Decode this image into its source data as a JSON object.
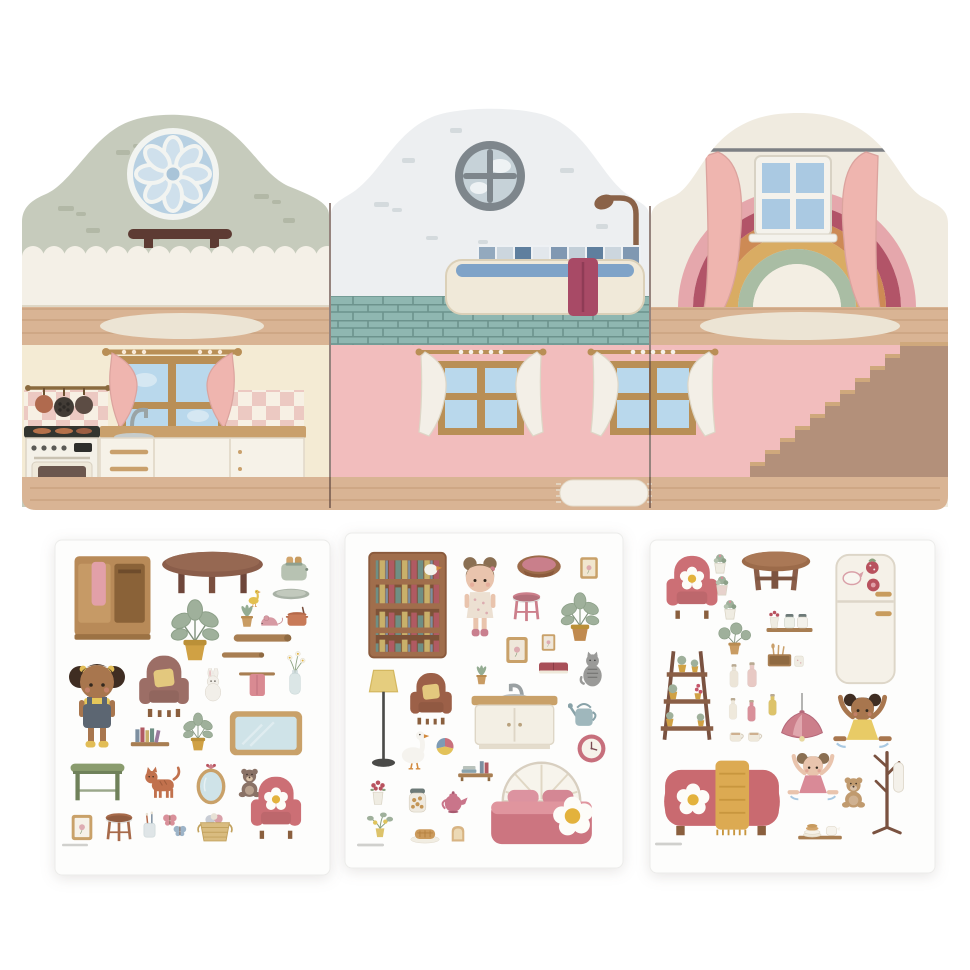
{
  "scene": "fold-out dollhouse backdrop with three sticker sheets of dollhouse furniture and dolls",
  "colors": {
    "page_bg": "#ffffff",
    "sheet_bg": "#fdfdfc",
    "wall_sage": "#c6cbbc",
    "wall_white": "#edeff1",
    "wall_cream": "#f0ebe0",
    "kitchen_wall": "#f4ebd4",
    "wall_pink": "#f2bdbd",
    "wood": "#d9b494",
    "wood_line": "#c49c78",
    "wood_top": "#c9a06c",
    "fence": "#f4f0e7",
    "curtain_pink": "#efb5af",
    "pane_blue": "#b9d8ec",
    "frame_wood": "#b98f56",
    "tile_teal": "#8fb7b1",
    "tile_grout": "#6c938d",
    "shelf_dark": "#5d3b33",
    "towel_magenta": "#a84a66",
    "stair": "#b3907a",
    "stair_tread": "#cfa87c",
    "rug_cream": "#ece4d4",
    "separator": "#6a5048",
    "rainbow_1": "#e5a7ac",
    "rainbow_2": "#b25468",
    "rainbow_3": "#cd8a55",
    "rainbow_4": "#d9ac63",
    "rainbow_5": "#a9bda4",
    "rainbow_center": "#f3eee3"
  },
  "backdrop": {
    "panels": [
      {
        "name": "left-panel",
        "upper_room": "living-room-attic",
        "upper_elements": [
          "rosette-window",
          "wall-shelf",
          "picket-fence",
          "oval-rug"
        ],
        "lower_room": "kitchen",
        "lower_elements": [
          "window-with-pink-curtains",
          "utensil-rail-with-pans",
          "checkered-backsplash",
          "stove-oven",
          "sink-counter-drawers"
        ]
      },
      {
        "name": "middle-panel",
        "upper_room": "bathroom",
        "upper_elements": [
          "porthole-window",
          "shower",
          "tile-strip",
          "bathtub",
          "magenta-towel",
          "teal-tiled-floor"
        ],
        "lower_room": "pink-room",
        "lower_elements": [
          "window-white-curtains-left",
          "window-white-curtains-right",
          "fringed-rug"
        ]
      },
      {
        "name": "right-panel",
        "upper_room": "attic-bedroom",
        "upper_elements": [
          "curtain-rod",
          "pink-curtains",
          "white-window",
          "rainbow",
          "oval-rug"
        ],
        "lower_room": "stair-hall",
        "lower_elements": [
          "staircase"
        ]
      }
    ]
  },
  "sheets": [
    {
      "id": "sheet-1",
      "items": [
        {
          "name": "wardrobe-with-towel",
          "icon": "wardrobe",
          "x": 10,
          "y": 8,
          "w": 95,
          "h": 100
        },
        {
          "name": "oval-coffee-table",
          "icon": "table-oval",
          "x": 100,
          "y": 10,
          "w": 115,
          "h": 45
        },
        {
          "name": "toaster",
          "icon": "toaster",
          "x": 222,
          "y": 10,
          "w": 34,
          "h": 38
        },
        {
          "name": "duckling",
          "icon": "bird",
          "x": 188,
          "y": 48,
          "w": 22,
          "h": 20,
          "c": {
            "a": "#e3c050"
          }
        },
        {
          "name": "serving-tray",
          "icon": "tray",
          "x": 212,
          "y": 46,
          "w": 48,
          "h": 16
        },
        {
          "name": "succulent",
          "icon": "plant-small",
          "x": 182,
          "y": 62,
          "w": 20,
          "h": 28
        },
        {
          "name": "toy-mouse",
          "icon": "mouse",
          "x": 200,
          "y": 72,
          "w": 30,
          "h": 18
        },
        {
          "name": "cooking-pot",
          "icon": "pot",
          "x": 228,
          "y": 64,
          "w": 28,
          "h": 26
        },
        {
          "name": "potted-plant",
          "icon": "plant",
          "x": 105,
          "y": 55,
          "w": 70,
          "h": 68
        },
        {
          "name": "shelf-board-long",
          "icon": "plank",
          "x": 165,
          "y": 92,
          "w": 85,
          "h": 12
        },
        {
          "name": "shelf-board-short",
          "icon": "plank",
          "x": 166,
          "y": 110,
          "w": 44,
          "h": 10
        },
        {
          "name": "doll-girl-overalls",
          "icon": "doll-pigtails",
          "x": 10,
          "y": 110,
          "w": 64,
          "h": 100,
          "c": {
            "s": "#a8764e",
            "h": "#3f2d22",
            "d": "#5c6672"
          }
        },
        {
          "name": "mauve-armchair",
          "icon": "armchair",
          "x": 78,
          "y": 110,
          "w": 62,
          "h": 72,
          "c": {
            "a": "#9c6e66",
            "b": "#e3c87e"
          }
        },
        {
          "name": "bunny",
          "icon": "bunny",
          "x": 143,
          "y": 128,
          "w": 30,
          "h": 34
        },
        {
          "name": "towel-rail",
          "icon": "towel-rail",
          "x": 180,
          "y": 126,
          "w": 44,
          "h": 34
        },
        {
          "name": "flower-vase",
          "icon": "vase-flowers",
          "x": 228,
          "y": 108,
          "w": 24,
          "h": 52
        },
        {
          "name": "wall-shelf-books",
          "icon": "wallshelf",
          "x": 70,
          "y": 182,
          "w": 50,
          "h": 32
        },
        {
          "name": "potted-plant-2",
          "icon": "plant",
          "x": 122,
          "y": 168,
          "w": 42,
          "h": 46,
          "c": {
            "a": "#d0a144"
          }
        },
        {
          "name": "blue-board",
          "icon": "board",
          "x": 170,
          "y": 165,
          "w": 82,
          "h": 55
        },
        {
          "name": "green-desk",
          "icon": "desk",
          "x": 10,
          "y": 215,
          "w": 65,
          "h": 49,
          "c": {
            "a": "#8a9c6e"
          }
        },
        {
          "name": "ginger-cat",
          "icon": "cat",
          "x": 83,
          "y": 220,
          "w": 47,
          "h": 44,
          "c": {
            "a": "#c1714d"
          }
        },
        {
          "name": "oval-mirror",
          "icon": "mirror",
          "x": 135,
          "y": 221,
          "w": 42,
          "h": 44
        },
        {
          "name": "teddy-bear",
          "icon": "teddy",
          "x": 180,
          "y": 225,
          "w": 29,
          "h": 34,
          "c": {
            "a": "#8a7266"
          }
        },
        {
          "name": "pink-armchair",
          "icon": "armchair-flower",
          "x": 186,
          "y": 233,
          "w": 70,
          "h": 69,
          "c": {
            "a": "#cc6f75"
          }
        },
        {
          "name": "picture-frame",
          "icon": "frame",
          "x": 12,
          "y": 273,
          "w": 30,
          "h": 29,
          "c": {
            "b": "#f6f1e8"
          }
        },
        {
          "name": "wooden-stool",
          "icon": "stool",
          "x": 46,
          "y": 271,
          "w": 36,
          "h": 31,
          "c": {
            "a": "#a76a4a"
          }
        },
        {
          "name": "toothbrush-glass",
          "icon": "toothcup",
          "x": 85,
          "y": 271,
          "w": 19,
          "h": 28
        },
        {
          "name": "butterflies",
          "icon": "butterflies",
          "x": 106,
          "y": 270,
          "w": 28,
          "h": 29
        },
        {
          "name": "laundry-basket",
          "icon": "basket",
          "x": 136,
          "y": 270,
          "w": 48,
          "h": 34
        },
        {
          "name": "fine-print",
          "icon": "fineprint",
          "x": 7,
          "y": 303,
          "w": 26,
          "h": 4
        }
      ]
    },
    {
      "id": "sheet-2",
      "items": [
        {
          "name": "bookcase",
          "icon": "bookcase",
          "x": 20,
          "y": 18,
          "w": 85,
          "h": 112
        },
        {
          "name": "doll-girl-dress",
          "icon": "doll-buns",
          "x": 110,
          "y": 15,
          "w": 50,
          "h": 100,
          "c": {
            "s": "#e9c4ad",
            "h": "#8a6f52",
            "d": "#ece0d2"
          }
        },
        {
          "name": "pet-bed",
          "icon": "petbed",
          "x": 168,
          "y": 18,
          "w": 52,
          "h": 29
        },
        {
          "name": "frame-flowers",
          "icon": "frame",
          "x": 233,
          "y": 18,
          "w": 22,
          "h": 34,
          "c": {
            "b": "#f1e6cf"
          }
        },
        {
          "name": "pink-stool",
          "icon": "stool",
          "x": 163,
          "y": 57,
          "w": 37,
          "h": 32,
          "c": {
            "a": "#cc7f8b"
          }
        },
        {
          "name": "potted-plant",
          "icon": "plant",
          "x": 208,
          "y": 52,
          "w": 54,
          "h": 62,
          "c": {
            "a": "#c08a4f"
          }
        },
        {
          "name": "frame-botanical-1",
          "icon": "frame",
          "x": 158,
          "y": 102,
          "w": 28,
          "h": 30,
          "c": {
            "b": "#efe7da"
          }
        },
        {
          "name": "frame-botanical-2",
          "icon": "frame",
          "x": 188,
          "y": 100,
          "w": 31,
          "h": 19,
          "c": {
            "b": "#efe7da"
          }
        },
        {
          "name": "red-book",
          "icon": "book",
          "x": 191,
          "y": 125,
          "w": 35,
          "h": 21
        },
        {
          "name": "grey-cat",
          "icon": "cat-sit",
          "x": 231,
          "y": 117,
          "w": 33,
          "h": 40,
          "c": {
            "a": "#9a9a98"
          }
        },
        {
          "name": "floor-lamp",
          "icon": "floorlamp",
          "x": 22,
          "y": 132,
          "w": 33,
          "h": 108
        },
        {
          "name": "brown-armchair",
          "icon": "armchair",
          "x": 60,
          "y": 133,
          "w": 52,
          "h": 65,
          "c": {
            "a": "#9c6048",
            "b": "#e3c87e"
          }
        },
        {
          "name": "succulent",
          "icon": "plant-small",
          "x": 126,
          "y": 130,
          "w": 21,
          "h": 24
        },
        {
          "name": "sink-cabinet",
          "icon": "sinkcab",
          "x": 120,
          "y": 147,
          "w": 99,
          "h": 70
        },
        {
          "name": "goose",
          "icon": "bird",
          "x": 51,
          "y": 192,
          "w": 36,
          "h": 49,
          "c": {
            "a": "#f5f3ee"
          }
        },
        {
          "name": "toy-ball",
          "icon": "ball",
          "x": 90,
          "y": 203,
          "w": 20,
          "h": 21
        },
        {
          "name": "book-shelf-tray",
          "icon": "bookstray",
          "x": 106,
          "y": 223,
          "w": 49,
          "h": 26
        },
        {
          "name": "watering-can",
          "icon": "wateringcan",
          "x": 223,
          "y": 165,
          "w": 32,
          "h": 33
        },
        {
          "name": "wall-clock",
          "icon": "clock",
          "x": 231,
          "y": 200,
          "w": 31,
          "h": 31
        },
        {
          "name": "doll-bed",
          "icon": "bed",
          "x": 131,
          "y": 222,
          "w": 131,
          "h": 92
        },
        {
          "name": "flower-pot",
          "icon": "flowerpot",
          "x": 21,
          "y": 247,
          "w": 24,
          "h": 27
        },
        {
          "name": "cookie-jar",
          "icon": "jar",
          "x": 60,
          "y": 253,
          "w": 25,
          "h": 29
        },
        {
          "name": "teapot",
          "icon": "teapot",
          "x": 93,
          "y": 255,
          "w": 32,
          "h": 27
        },
        {
          "name": "lemon-plant",
          "icon": "plantlemon",
          "x": 18,
          "y": 278,
          "w": 34,
          "h": 29
        },
        {
          "name": "pie",
          "icon": "pie",
          "x": 63,
          "y": 288,
          "w": 34,
          "h": 23
        },
        {
          "name": "bread",
          "icon": "bread",
          "x": 101,
          "y": 290,
          "w": 24,
          "h": 21
        },
        {
          "name": "fine-print",
          "icon": "fineprint",
          "x": 12,
          "y": 310,
          "w": 27,
          "h": 4
        }
      ]
    },
    {
      "id": "sheet-3",
      "items": [
        {
          "name": "pink-armchair",
          "icon": "armchair-flower",
          "x": 5,
          "y": 12,
          "w": 74,
          "h": 70,
          "c": {
            "a": "#cc6f75"
          }
        },
        {
          "name": "mini-plant-1",
          "icon": "minipot",
          "x": 60,
          "y": 12,
          "w": 20,
          "h": 24
        },
        {
          "name": "mini-plant-2",
          "icon": "minipot",
          "x": 62,
          "y": 34,
          "w": 20,
          "h": 24,
          "c": {
            "a": "#e7d2cc"
          }
        },
        {
          "name": "mini-plant-3",
          "icon": "minipot",
          "x": 70,
          "y": 58,
          "w": 20,
          "h": 24
        },
        {
          "name": "round-table",
          "icon": "roundtable",
          "x": 88,
          "y": 9,
          "w": 76,
          "h": 46
        },
        {
          "name": "fridge-with-magnets",
          "icon": "fridge",
          "x": 176,
          "y": 11,
          "w": 79,
          "h": 136
        },
        {
          "name": "wall-shelf-jars",
          "icon": "shelfjars",
          "x": 112,
          "y": 70,
          "w": 55,
          "h": 25
        },
        {
          "name": "round-leaf-plant",
          "icon": "plantround",
          "x": 62,
          "y": 82,
          "w": 45,
          "h": 35
        },
        {
          "name": "utensil-box",
          "icon": "boxutensils",
          "x": 112,
          "y": 103,
          "w": 48,
          "h": 26
        },
        {
          "name": "plant-ladder",
          "icon": "plantladder",
          "x": 7,
          "y": 103,
          "w": 60,
          "h": 105
        },
        {
          "name": "bottle-cream",
          "icon": "bottle",
          "x": 76,
          "y": 122,
          "w": 16,
          "h": 28,
          "c": {
            "a": "#ece5d8"
          }
        },
        {
          "name": "bottle-blush",
          "icon": "bottle",
          "x": 94,
          "y": 120,
          "w": 16,
          "h": 30,
          "c": {
            "a": "#e8c9c4"
          }
        },
        {
          "name": "bottle-small",
          "icon": "bottle",
          "x": 76,
          "y": 156,
          "w": 14,
          "h": 26,
          "c": {
            "a": "#efe9dc"
          }
        },
        {
          "name": "pink-tube",
          "icon": "bottle",
          "x": 95,
          "y": 158,
          "w": 13,
          "h": 26,
          "c": {
            "a": "#d9909a"
          }
        },
        {
          "name": "yellow-bottle",
          "icon": "bottle",
          "x": 116,
          "y": 152,
          "w": 13,
          "h": 26,
          "c": {
            "a": "#ddc36a"
          }
        },
        {
          "name": "tea-cups",
          "icon": "cups",
          "x": 75,
          "y": 186,
          "w": 42,
          "h": 20
        },
        {
          "name": "pendant-lamp",
          "icon": "pendantlamp",
          "x": 126,
          "y": 152,
          "w": 52,
          "h": 56
        },
        {
          "name": "doll-dancing-yellow",
          "icon": "doll-dance",
          "x": 180,
          "y": 152,
          "w": 65,
          "h": 62,
          "c": {
            "s": "#a8764e",
            "h": "#3f2d22",
            "d": "#e8cb66"
          }
        },
        {
          "name": "coat-rack",
          "icon": "coatrack",
          "x": 215,
          "y": 200,
          "w": 44,
          "h": 100
        },
        {
          "name": "sofa-with-blanket",
          "icon": "sofa",
          "x": 6,
          "y": 215,
          "w": 132,
          "h": 84,
          "c": {
            "a": "#c96a70"
          }
        },
        {
          "name": "doll-dancing-pink",
          "icon": "doll-dance",
          "x": 136,
          "y": 205,
          "w": 54,
          "h": 67,
          "c": {
            "s": "#e9c4ad",
            "h": "#8a6f52",
            "d": "#d98a97"
          }
        },
        {
          "name": "teddy-bear",
          "icon": "teddy",
          "x": 188,
          "y": 233,
          "w": 31,
          "h": 37,
          "c": {
            "a": "#c09a6e"
          }
        },
        {
          "name": "plates-tray",
          "icon": "platestray",
          "x": 141,
          "y": 276,
          "w": 58,
          "h": 26
        },
        {
          "name": "fine-print",
          "icon": "fineprint",
          "x": 5,
          "y": 302,
          "w": 27,
          "h": 4
        }
      ]
    }
  ]
}
